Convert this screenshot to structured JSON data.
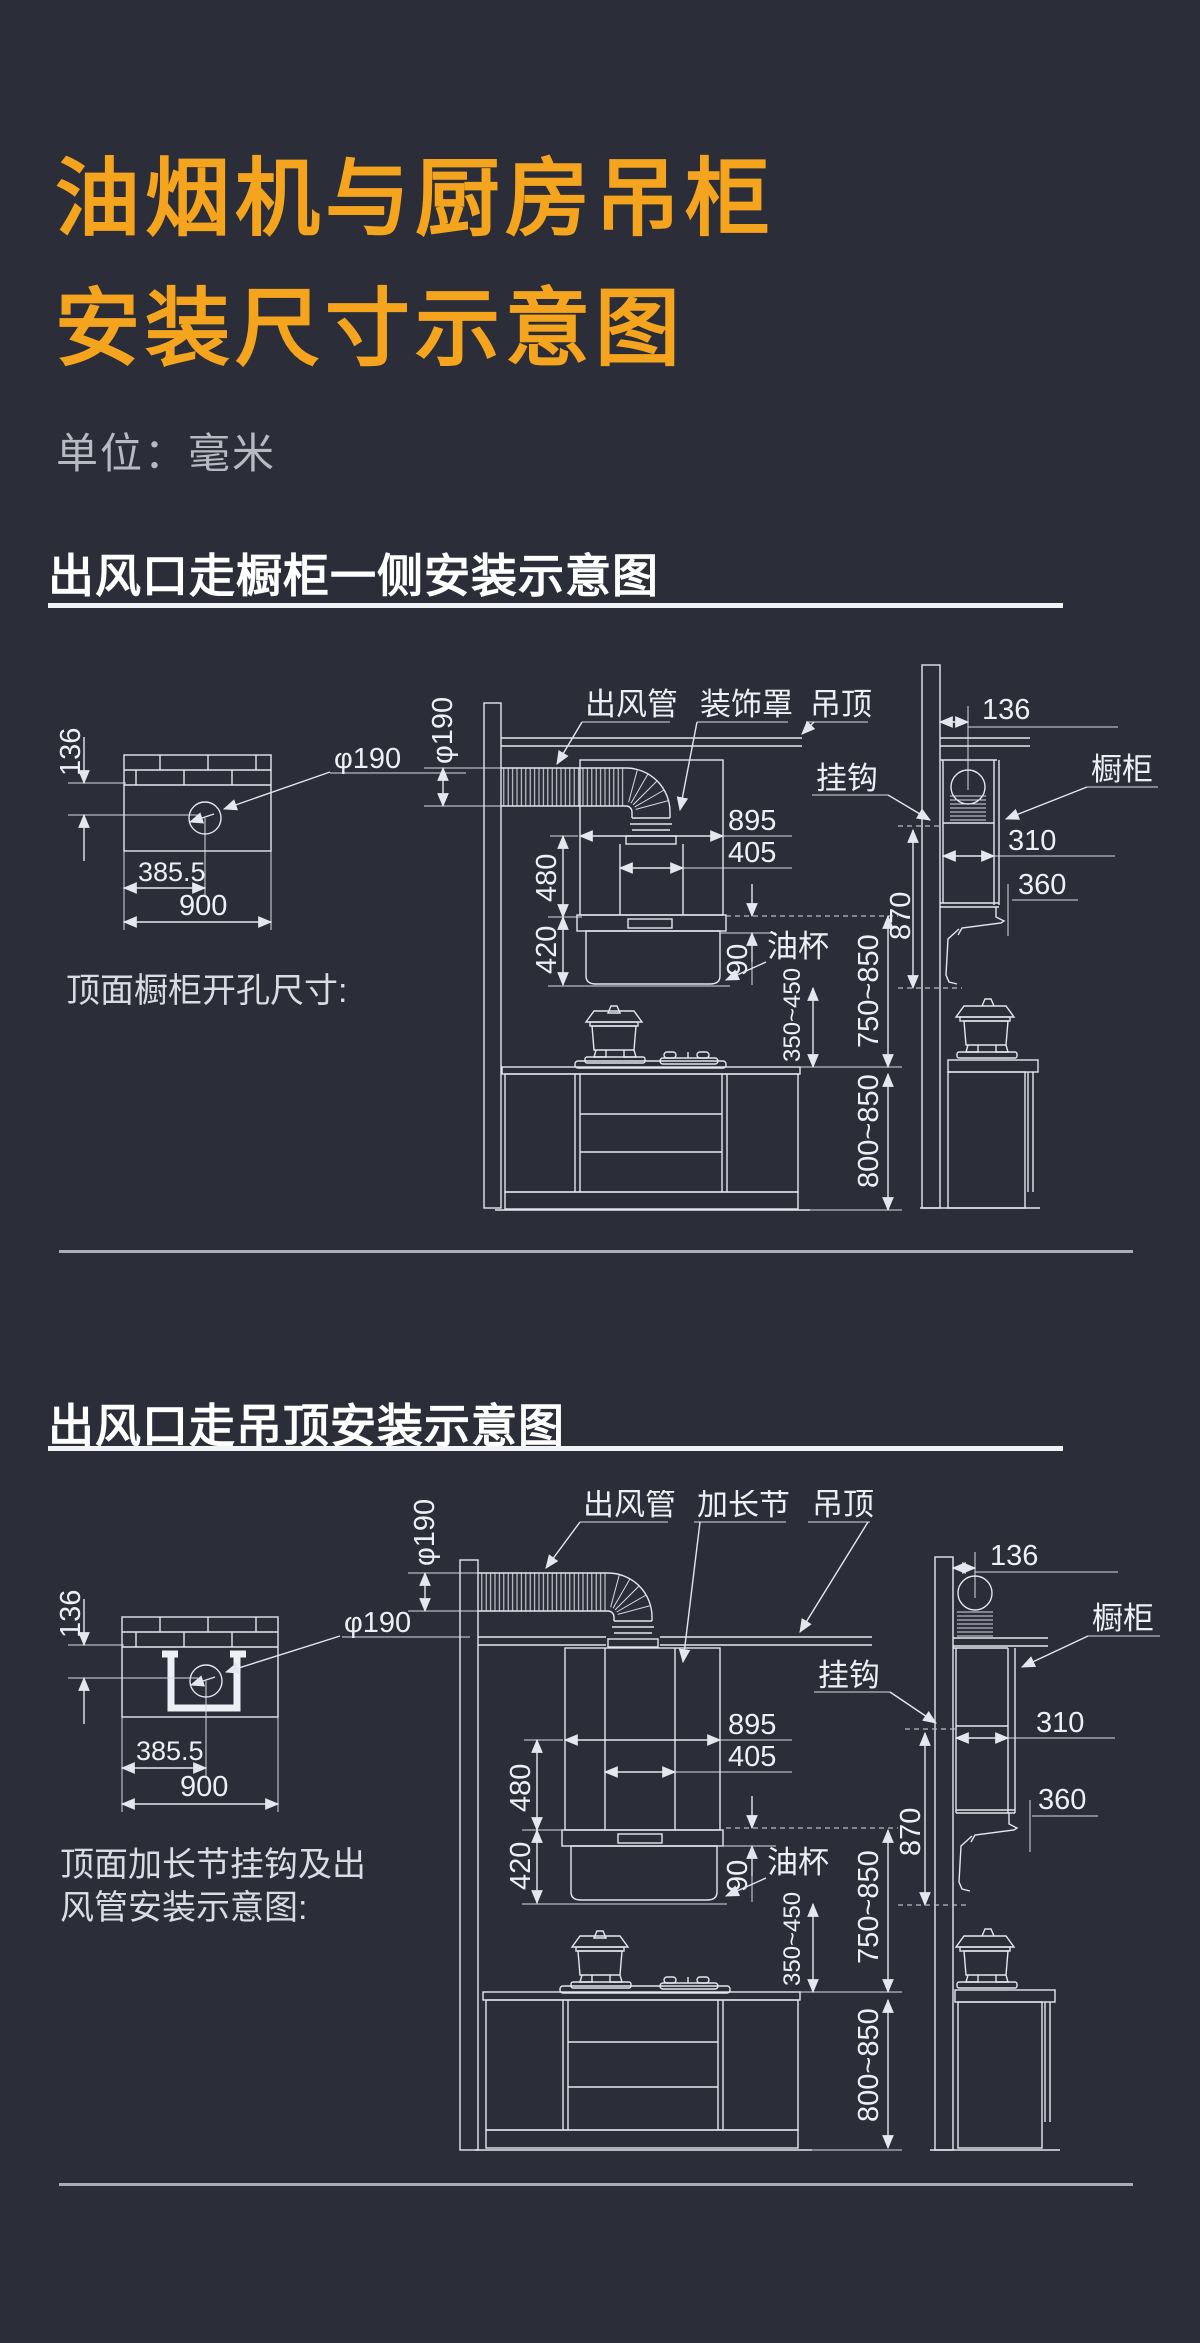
{
  "page": {
    "background": "#2b2d39",
    "accent_orange": "#f5a41e",
    "line_color": "#e4e7ee"
  },
  "header": {
    "title_line1": "油烟机与厨房吊柜",
    "title_line2": "安装尺寸示意图",
    "units_label": "单位：毫米"
  },
  "section1": {
    "heading": "出风口走橱柜一侧安装示意图",
    "cutout": {
      "caption": "顶面橱柜开孔尺寸:",
      "dims": {
        "edge_offset": "136",
        "hole_center_x": "385.5",
        "cabinet_width": "900",
        "hole_diameter": "φ190"
      }
    },
    "front": {
      "labels": {
        "duct": "出风管",
        "decor_cover": "装饰罩",
        "ceiling": "吊顶",
        "hook": "挂钩",
        "oil_cup": "油杯"
      },
      "dims": {
        "duct_diameter": "φ190",
        "hood_width": "895",
        "outlet_width": "405",
        "cover_height": "480",
        "hood_height": "420",
        "oil_cup_height": "90",
        "hood_to_stove": "350~450",
        "hood_to_counter": "750~850",
        "counter_height": "800~850"
      }
    },
    "side": {
      "labels": {
        "cabinet": "橱柜"
      },
      "dims": {
        "wall_offset": "136",
        "cabinet_depth": "310",
        "hood_depth": "360",
        "hook_height": "870"
      }
    }
  },
  "section2": {
    "heading": "出风口走吊顶安装示意图",
    "cutout": {
      "caption_line1": "顶面加长节挂钩及出",
      "caption_line2": "风管安装示意图:",
      "dims": {
        "edge_offset": "136",
        "hole_center_x": "385.5",
        "cabinet_width": "900",
        "hole_diameter": "φ190"
      }
    },
    "front": {
      "labels": {
        "duct": "出风管",
        "extension": "加长节",
        "ceiling": "吊顶",
        "hook": "挂钩",
        "oil_cup": "油杯"
      },
      "dims": {
        "duct_diameter": "φ190",
        "hood_width": "895",
        "outlet_width": "405",
        "cover_height": "480",
        "hood_height": "420",
        "oil_cup_height": "90",
        "hood_to_stove": "350~450",
        "hood_to_counter": "750~850",
        "counter_height": "800~850"
      }
    },
    "side": {
      "labels": {
        "cabinet": "橱柜"
      },
      "dims": {
        "wall_offset": "136",
        "cabinet_depth": "310",
        "hood_depth": "360",
        "hook_height": "870"
      }
    }
  }
}
